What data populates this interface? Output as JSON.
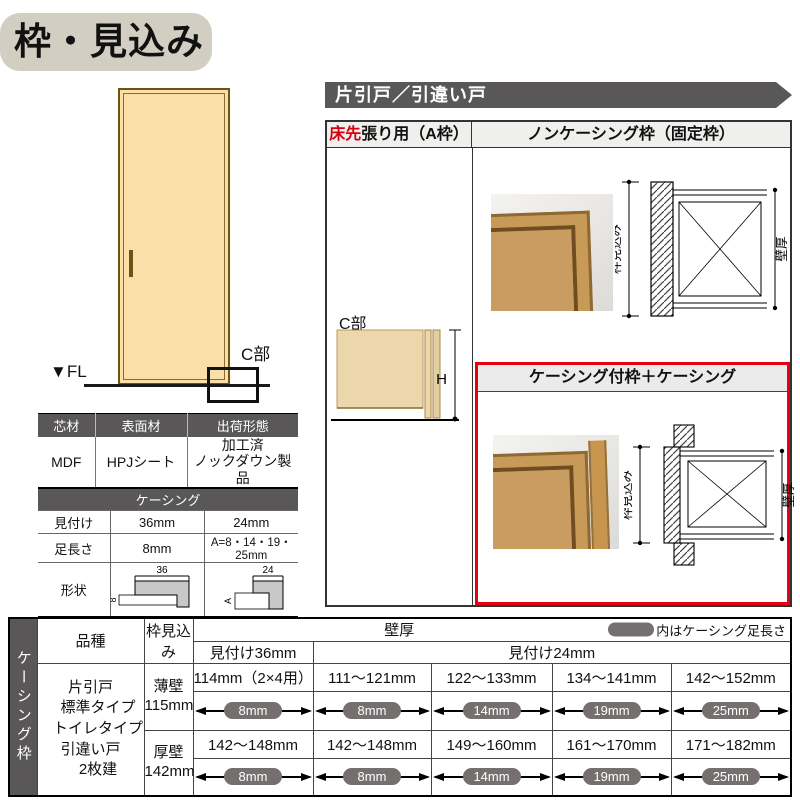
{
  "title": "枠・見込み",
  "banner": "片引戸／引違い戸",
  "door_figure": {
    "fl": "▼FL",
    "c_label": "C部"
  },
  "material_table": {
    "headers": [
      "芯材",
      "表面材",
      "出荷形態"
    ],
    "values": [
      "MDF",
      "HPJシート",
      "加工済\nノックダウン製品"
    ]
  },
  "casing_table": {
    "title": "ケーシング",
    "row1": {
      "label": "見付け",
      "v36": "36mm",
      "v24": "24mm"
    },
    "row2": {
      "label": "足長さ",
      "v36": "8mm",
      "v24": "A=8・14・19・25mm"
    },
    "row3": {
      "label": "形状",
      "dim36": "36",
      "leg36": "8",
      "dim24": "24",
      "leg24": "A"
    }
  },
  "spec_panel": {
    "header_a_red": "床先",
    "header_a": "張り用（A枠）",
    "header_noncasing": "ノンケーシング枠（固定枠）",
    "header_casing": "ケーシング付枠＋ケーシング",
    "c_label": "C部",
    "h_label": "H",
    "dim_frame": "枠見込み",
    "dim_wall": "壁厚"
  },
  "bottom_table": {
    "side_label": "ケーシング枠",
    "h_hinshu": "品種",
    "h_mikomi": "枠見込み",
    "h_kabeatsu": "壁厚",
    "note": "内はケーシング足長さ",
    "h_sub36": "見付け36mm",
    "h_sub24": "見付け24mm",
    "hinshu": "片引戸\n　標準タイプ\n　トイレタイプ\n引違い戸\n　2枚建",
    "rows": [
      {
        "wall": "薄壁\n115mm",
        "values": [
          "114mm（2×4用）",
          "111～121mm",
          "122～133mm",
          "134～141mm",
          "142～152mm"
        ],
        "pills": [
          "8mm",
          "8mm",
          "14mm",
          "19mm",
          "25mm"
        ]
      },
      {
        "wall": "厚壁\n142mm",
        "values": [
          "142～148mm",
          "142～148mm",
          "149～160mm",
          "161～170mm",
          "171～182mm"
        ],
        "pills": [
          "8mm",
          "8mm",
          "14mm",
          "19mm",
          "25mm"
        ]
      }
    ]
  },
  "colors": {
    "dark_gray": "#595757",
    "section_header_bg": "#ebebeb",
    "title_bg": "#d2cec1",
    "door_fill": "#fbdfa9",
    "door_border": "#6e5413",
    "pill_gray": "#757070",
    "highlight_red": "#e60012",
    "wood": "#c89a58"
  }
}
